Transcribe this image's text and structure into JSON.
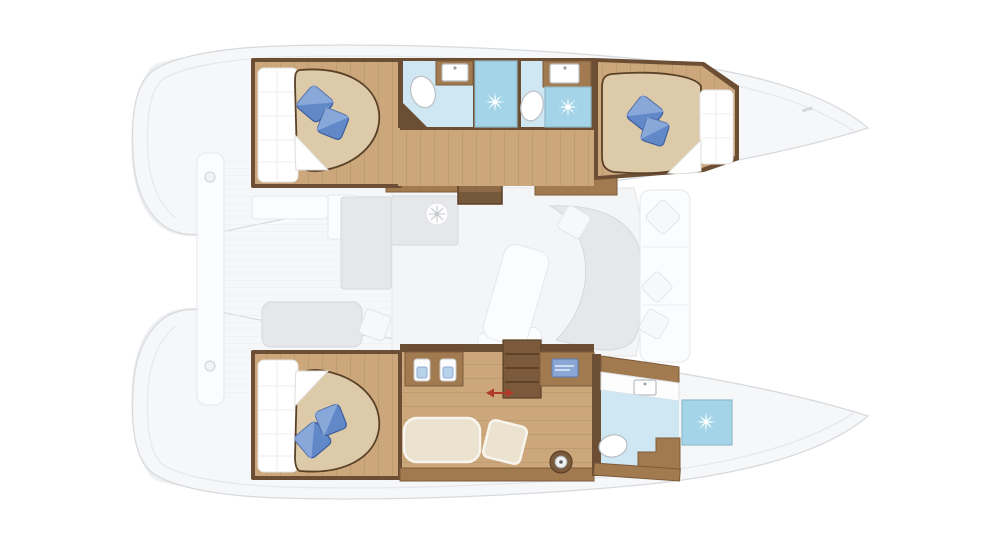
{
  "meta": {
    "title": "Catamaran interior layout plan — top-down deck view, bow to the right",
    "view": "floorplan",
    "orientation": "bow-right"
  },
  "colors": {
    "hull": "#f6f7f8",
    "hull_line": "#d8dade",
    "deck_line": "#e7e9ec",
    "stern_shade": "#eef0f2",
    "stern_shade_dark": "#e4e7ea",
    "furn_gray": "#e6e7ea",
    "furn_gray_line": "#d6d8db",
    "wall_wood": "#6b4e33",
    "counter_wood": "#a17a50",
    "counter_wood_line": "#7c5c3b",
    "floor_wood": "#cba77b",
    "stair_light": "#8e6b46",
    "stair_dark": "#75573a",
    "bed_tan": "#dccaa9",
    "bed_line": "#5a4128",
    "mattress": "#ffffff",
    "pillow_blue": "#6189c8",
    "pillow_blue_dark": "#3f5f9d",
    "pillow_hi": "#9cb8e3",
    "bath_floor": "#cfe7f3",
    "shower_blue": "#a4d4e7",
    "shower_line": "#8fb9cc",
    "cream": "#ebe2d0",
    "cream_line": "#f8f5ee",
    "laptop_blue": "#8aa6d4",
    "laptop_line": "#5d7bb0",
    "arrow_red": "#b03a28",
    "dark_unit": "#7a5a3a"
  },
  "rooms": {
    "cabin_port_aft": {
      "label": "Port hull aft cabin",
      "furniture": [
        "island double bed",
        "two blue pillows",
        "mattress shelf"
      ]
    },
    "head_port_aft": {
      "label": "Port hull aft bathroom",
      "furniture": [
        "toilet",
        "sink vanity",
        "shower with drain"
      ]
    },
    "head_port_fwd": {
      "label": "Port hull forward bathroom",
      "furniture": [
        "toilet",
        "sink vanity",
        "shower with drain"
      ]
    },
    "cabin_port_fwd": {
      "label": "Port hull forward cabin",
      "furniture": [
        "island double bed",
        "blue pillows"
      ]
    },
    "saloon": {
      "label": "Saloon and galley",
      "furniture": [
        "galley counters",
        "round fixture",
        "dining table",
        "curved sofa",
        "white pillow",
        "chart table with laptop",
        "galley sinks",
        "companionway stairs"
      ]
    },
    "cockpit": {
      "label": "Aft cockpit",
      "furniture": [
        "bench seats",
        "white cushion",
        "transom platform"
      ]
    },
    "foredeck": {
      "label": "Foredeck lounge",
      "furniture": [
        "forward sofa",
        "three white cushions"
      ]
    },
    "cabin_stbd_aft": {
      "label": "Starboard hull owner aft cabin",
      "furniture": [
        "island double bed",
        "two blue pillows"
      ]
    },
    "owner_lounge": {
      "label": "Starboard hull dressing / office area",
      "furniture": [
        "vanity desk with twin basins",
        "desk with laptop",
        "shelf unit",
        "sliding door (red arrow)",
        "cream sofa",
        "ottoman",
        "washing machine porthole"
      ]
    },
    "head_stbd_fwd": {
      "label": "Starboard hull owner bathroom",
      "furniture": [
        "toilet",
        "sink vanity",
        "corner counter",
        "shower with drain"
      ]
    }
  }
}
